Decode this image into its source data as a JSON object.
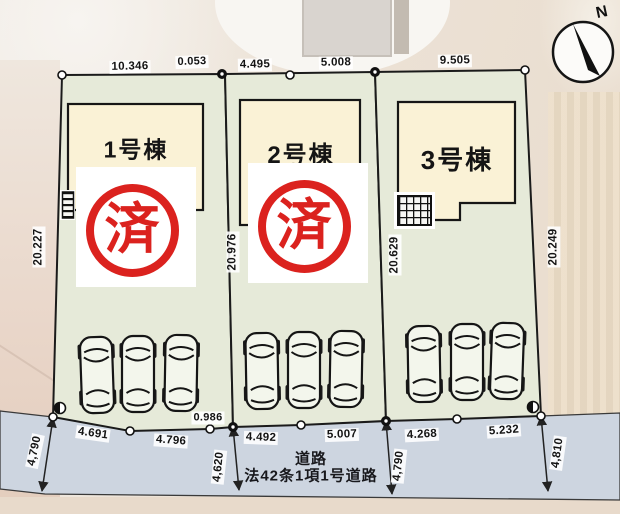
{
  "compass": {
    "north_label": "N"
  },
  "lots": [
    {
      "building_label": "1号棟",
      "stamp_label": "済"
    },
    {
      "building_label": "2号棟",
      "stamp_label": "済"
    },
    {
      "building_label": "3号棟"
    }
  ],
  "dimensions": {
    "top": [
      "10.346",
      "0.053",
      "4.495",
      "5.008",
      "9.505"
    ],
    "verticals": [
      "20.227",
      "20.976",
      "20.629",
      "20.249"
    ],
    "bottom": [
      "4.691",
      "4.796",
      "0.986",
      "4.492",
      "5.007",
      "4.268",
      "5.232"
    ],
    "road_widths": [
      "4,790",
      "4,620",
      "4,790",
      "4,810"
    ]
  },
  "road": {
    "label_line1": "道路",
    "label_line2": "法42条1項1号道路"
  },
  "colors": {
    "lot_fill": "#e6ead9",
    "building_fill": "#faf2d6",
    "road_fill": "#cdd5e0",
    "stamp_red": "#db221e",
    "outline": "#1b1b1b"
  }
}
